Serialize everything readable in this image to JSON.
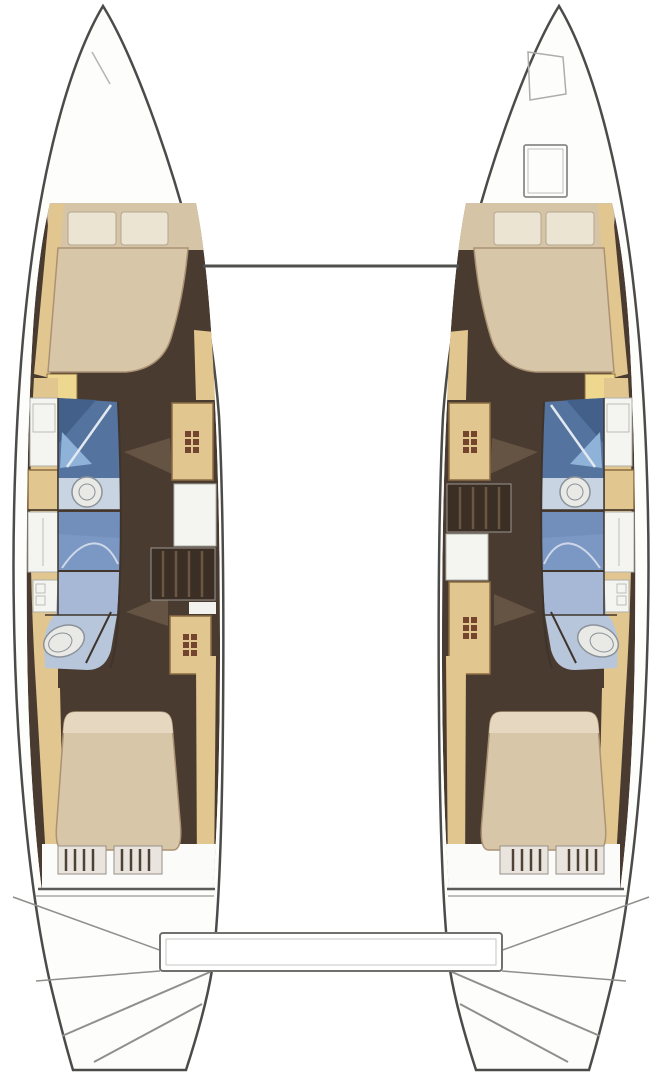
{
  "diagram": {
    "kind": "catamaran-interior-floor-plan",
    "visible_text": [],
    "hulls": [
      {
        "name": "port-hull",
        "rooms": [
          "forward-cabin-double-berth",
          "bathroom-shower",
          "washbasin",
          "bathroom-shower-2",
          "toilet",
          "companionway-stairs",
          "aft-cabin-double-berth",
          "transom-steps"
        ]
      },
      {
        "name": "starboard-hull",
        "rooms": [
          "bow-locker",
          "deck-hatch",
          "forward-cabin-double-berth",
          "bathroom-shower",
          "washbasin",
          "bathroom-shower-2",
          "toilet",
          "companionway-stairs",
          "aft-cabin-double-berth",
          "transom-steps"
        ]
      }
    ],
    "connections": [
      "forward-crossbeam",
      "aft-transom-bar"
    ]
  },
  "icons": {
    "stairs-icon": "grid-of-dark-squares",
    "washbasin-icon": "double-circle",
    "toilet-icon": "double-ellipse",
    "shower-glass-icon": "diagonal-line",
    "door-swing-icon": "triangle-wedge",
    "deck-hatch-icon": "rounded-square-outline",
    "bow-locker-icon": "trapezoid-outline"
  },
  "colors": {
    "hull_fill": "#fdfdfc",
    "hull_stroke": "#4b4b49",
    "floor_dark": "#4a3b30",
    "wood_tan": "#e2c68f",
    "wood_stroke": "#8a6d42",
    "wood_bright": "#eed88f",
    "backdrop_beige": "#d5c4a6",
    "bed_beige": "#d8c6a8",
    "bed_stroke": "#ab9274",
    "bed_head": "#e6d8c0",
    "pillow": "#ece4d3",
    "pillow_stroke": "#b5a68e",
    "fixture_white": "#f4f4f1",
    "fixture_stroke": "#b0b0aa",
    "porcelain": "#e9eae6",
    "porcelain_stroke": "#8b9299",
    "shower_dark": "#54749f",
    "shower_darker": "#43608a",
    "shower_highlight": "#8fb2d8",
    "blue_mid": "#7b97c3",
    "blue_light": "#a6b8d5",
    "counter_blue": "#c9d4e2",
    "toilet_floor": "#b7c6da",
    "divider_dark": "#3f342b",
    "steps_dark": "#3a2e25",
    "steps_tread": "#6b5742",
    "stair_icon": "#73452f",
    "door_swing": "#6a5848",
    "line_gray": "#8f8f8b",
    "deck_faint": "#b9b5ae",
    "beam_dark": "#4f4f4d",
    "end_line": "#5a5a57",
    "drawer_bg": "#e9e5de",
    "drawer_stroke": "#97928a",
    "drawer_stripe": "#4e4237",
    "white_soft": "#fbfbf9"
  }
}
